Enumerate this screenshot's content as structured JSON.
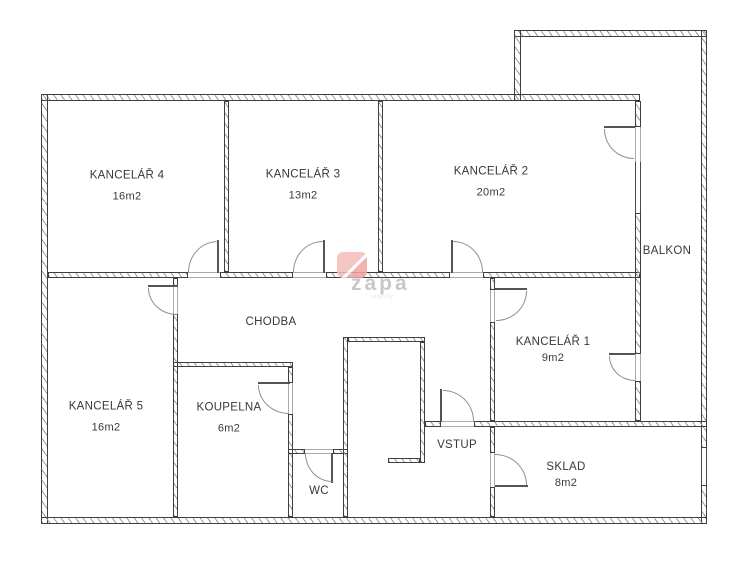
{
  "floorplan": {
    "rooms": {
      "kancelar4": {
        "label": "KANCELÁŘ 4",
        "area": "16m2"
      },
      "kancelar3": {
        "label": "KANCELÁŘ 3",
        "area": "13m2"
      },
      "kancelar2": {
        "label": "KANCELÁŘ 2",
        "area": "20m2"
      },
      "kancelar1": {
        "label": "KANCELÁŘ 1",
        "area": "9m2"
      },
      "kancelar5": {
        "label": "KANCELÁŘ 5",
        "area": "16m2"
      },
      "koupelna": {
        "label": "KOUPELNA",
        "area": "6m2"
      },
      "sklad": {
        "label": "SKLAD",
        "area": "8m2"
      },
      "chodba": {
        "label": "CHODBA"
      },
      "wc": {
        "label": "WC"
      },
      "vstup": {
        "label": "VSTUP"
      },
      "balkon": {
        "label": "BALKON"
      }
    },
    "watermark": {
      "brand": "zapa",
      "sub": "reality",
      "logo_color": "#f2aca8",
      "text_color": "#c8c8c8"
    },
    "style": {
      "wall_outline_color": "#3f3f3f",
      "hatch_color": "#9a9a9a",
      "label_color": "#383838",
      "background": "#ffffff"
    }
  }
}
